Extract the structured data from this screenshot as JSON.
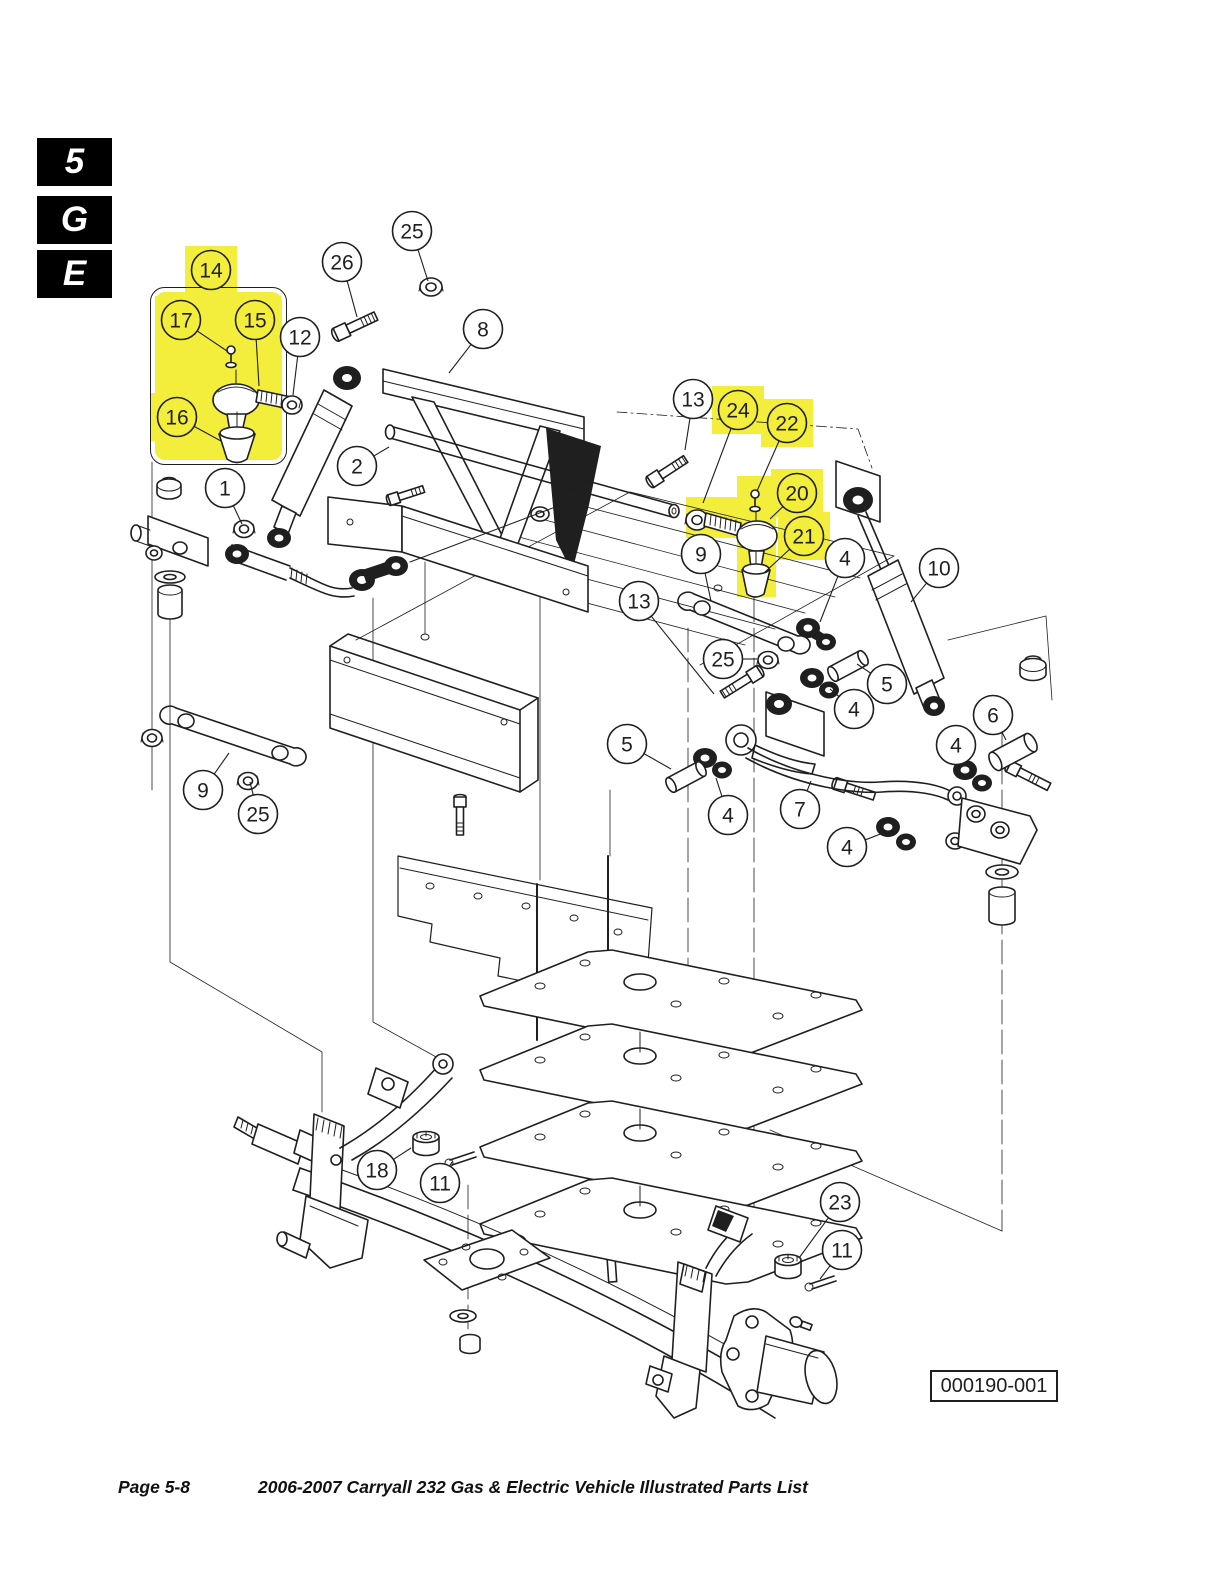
{
  "page_tabs": [
    {
      "label": "5"
    },
    {
      "label": "G"
    },
    {
      "label": "E"
    }
  ],
  "colors": {
    "highlight": "#f3ee3b",
    "ink": "#1f1f1f",
    "paper": "#ffffff"
  },
  "diagram": {
    "figure_number": "000190-001",
    "callouts": [
      {
        "n": "14",
        "x": 211,
        "y": 270,
        "hl": true
      },
      {
        "n": "26",
        "x": 342,
        "y": 262,
        "tx": 357,
        "ty": 317
      },
      {
        "n": "25",
        "x": 412,
        "y": 231,
        "tx": 428,
        "ty": 281
      },
      {
        "n": "8",
        "x": 483,
        "y": 329,
        "tx": 449,
        "ty": 373
      },
      {
        "n": "17",
        "x": 181,
        "y": 320,
        "hl": true,
        "tx": 227,
        "ty": 351
      },
      {
        "n": "15",
        "x": 255,
        "y": 320,
        "hl": true,
        "tx": 259,
        "ty": 386
      },
      {
        "n": "12",
        "x": 300,
        "y": 337,
        "tx": 293,
        "ty": 395
      },
      {
        "n": "16",
        "x": 177,
        "y": 417,
        "hl": true,
        "tx": 221,
        "ty": 441
      },
      {
        "n": "2",
        "x": 357,
        "y": 466,
        "tx": 389,
        "ty": 447
      },
      {
        "n": "1",
        "x": 225,
        "y": 488,
        "tx": 242,
        "ty": 524
      },
      {
        "n": "13",
        "x": 693,
        "y": 399,
        "tx": 685,
        "ty": 450
      },
      {
        "n": "24",
        "x": 738,
        "y": 410,
        "hl": true,
        "tx": 703,
        "ty": 503
      },
      {
        "n": "22",
        "x": 787,
        "y": 423,
        "hl": true,
        "tx": 757,
        "ty": 491
      },
      {
        "n": "20",
        "x": 797,
        "y": 493,
        "hl": true,
        "tx": 770,
        "ty": 519
      },
      {
        "n": "21",
        "x": 804,
        "y": 536,
        "hl": true,
        "tx": 765,
        "ty": 572
      },
      {
        "n": "9",
        "x": 701,
        "y": 554,
        "tx": 711,
        "ty": 601
      },
      {
        "n": "4",
        "x": 845,
        "y": 558,
        "tx": 820,
        "ty": 622
      },
      {
        "n": "10",
        "x": 939,
        "y": 568,
        "tx": 911,
        "ty": 602
      },
      {
        "n": "13",
        "x": 639,
        "y": 601,
        "tx": 714,
        "ty": 694
      },
      {
        "n": "25",
        "x": 723,
        "y": 659,
        "tx": 757,
        "ty": 659
      },
      {
        "n": "5",
        "x": 887,
        "y": 684,
        "tx": 857,
        "ty": 664
      },
      {
        "n": "4",
        "x": 854,
        "y": 709,
        "tx": 830,
        "ty": 689
      },
      {
        "n": "6",
        "x": 993,
        "y": 715,
        "tx": 1006,
        "ty": 740
      },
      {
        "n": "5",
        "x": 627,
        "y": 744,
        "tx": 671,
        "ty": 769
      },
      {
        "n": "4",
        "x": 728,
        "y": 815,
        "tx": 716,
        "ty": 778
      },
      {
        "n": "7",
        "x": 800,
        "y": 809,
        "tx": 811,
        "ty": 781
      },
      {
        "n": "4",
        "x": 956,
        "y": 745,
        "tx": 968,
        "ty": 766
      },
      {
        "n": "4",
        "x": 847,
        "y": 847,
        "tx": 883,
        "ty": 833
      },
      {
        "n": "9",
        "x": 203,
        "y": 790,
        "tx": 229,
        "ty": 753
      },
      {
        "n": "25",
        "x": 258,
        "y": 814,
        "tx": 250,
        "ty": 782
      },
      {
        "n": "18",
        "x": 377,
        "y": 1170,
        "tx": 411,
        "ty": 1148
      },
      {
        "n": "11",
        "x": 440,
        "y": 1183,
        "tx": 452,
        "ty": 1162
      },
      {
        "n": "23",
        "x": 840,
        "y": 1202,
        "tx": 799,
        "ty": 1258
      },
      {
        "n": "11",
        "x": 842,
        "y": 1250,
        "tx": 820,
        "ty": 1279
      }
    ]
  },
  "footer": {
    "page_label": "Page 5-8",
    "title": "2006-2007 Carryall 232 Gas & Electric Vehicle Illustrated Parts List"
  }
}
